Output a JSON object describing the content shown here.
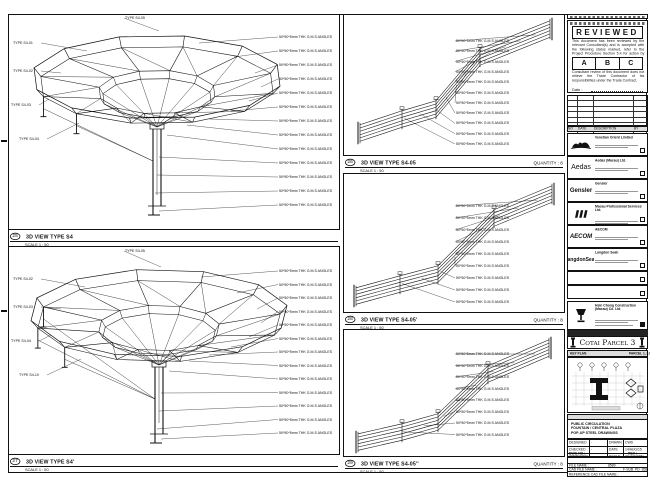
{
  "panels": {
    "tl": {
      "num": "25",
      "title": "3D VIEW TYPE S4",
      "scale": "SCALE 1 : 50"
    },
    "bl": {
      "num": "27",
      "title": "3D VIEW TYPE S4'",
      "scale": "SCALE 1 : 50"
    },
    "m1": {
      "num": "26",
      "title": "3D VIEW TYPE S4-05",
      "scale": "SCALE 1 : 50",
      "quantity": "QUANTITY : 8"
    },
    "m2": {
      "num": "28",
      "title": "3D VIEW TYPE S4-05'",
      "scale": "SCALE 1 : 50",
      "quantity": "QUANTITY : 8"
    },
    "m3": {
      "num": "29",
      "title": "3D VIEW TYPE S4-05''",
      "scale": "SCALE 1 : 50",
      "quantity": "QUANTITY : 8"
    }
  },
  "callouts": {
    "angle": "50*50*5mm THK G.M.S ANGLES",
    "types": [
      "TYPE S4-01",
      "TYPE S4-02",
      "TYPE S4-03",
      "TYPE S4-04",
      "TYPE S4-05",
      "TYPE S4-06",
      "TYPE S4-10"
    ]
  },
  "stamp": {
    "title": "REVIEWED",
    "body": "This document has been reviewed by the relevant Consultant(s) and is accepted with the following status marked, refer to the Project Procedure Section 5.4 for action by the Trade Contractor.",
    "grades": [
      "A",
      "B",
      "C"
    ],
    "note": "Consultant review of this document does not relieve the Trade Contractor of his responsibilities under the Trade Contract.",
    "date_label": "Date :"
  },
  "revision_table": {
    "headers": [
      "NO",
      "DATE",
      "DESCRIPTION",
      "BY"
    ]
  },
  "companies": [
    {
      "name": "Venetian Orient Limited",
      "logo": "venetian",
      "logo_text": ""
    },
    {
      "name": "Aedas (Macau) Ltd.",
      "logo": "aedas",
      "logo_text": "Aedas"
    },
    {
      "name": "Gensler",
      "logo": "gensler",
      "logo_text": "Gensler"
    },
    {
      "name": "Macau Professional Services Ltd.",
      "logo": "mps",
      "logo_text": ""
    },
    {
      "name": "AECOM",
      "logo": "aecom",
      "logo_text": "AECOM"
    },
    {
      "name": "Langdon Seah",
      "logo": "langdon",
      "logo_text": "LangdonSeah"
    },
    {
      "name": "",
      "logo": "none",
      "logo_text": ""
    },
    {
      "name": "",
      "logo": "none",
      "logo_text": ""
    }
  ],
  "contractor": {
    "name": "Hsin Chong Construction (Macau) Co. Ltd."
  },
  "project": {
    "label": "PROJECT TITLE",
    "title": "Cotai Parcel 3"
  },
  "keyplan": {
    "label": "KEY PLAN",
    "sub": "PARCEL 1, LOT 2"
  },
  "drawing_title": {
    "label": "DRAWING TITLE :",
    "line1": "PUBLIC CIRCULATION",
    "line2": "FOUNTAIN / CENTRAL PLAZA",
    "line3": "POP-UP STEEL DRAWINGS"
  },
  "fields": {
    "designed_label": "DESIGNED",
    "designed": "-",
    "drawn_label": "DRAWN",
    "drawn": "CWD",
    "checked_label": "CHECKED",
    "checked": "-",
    "date_label": "DATE",
    "date": "14/AUG/15",
    "approved_label": "APPROVED",
    "approved": "-",
    "scale_label": "SCALE",
    "scale": "AS SHOWN",
    "dwg_label": "DWG NO :",
    "dwg": "F-SUB_PD_8589",
    "rev_label": "REV :",
    "rev": "A",
    "file_label": "FILE NAME :",
    "file": "8589",
    "cad_label": "CAD FILE NAME :",
    "cad": "F-SUB_PD_8589.dwg",
    "ref_label": "REFERENCE CAD FILE NAME :"
  }
}
